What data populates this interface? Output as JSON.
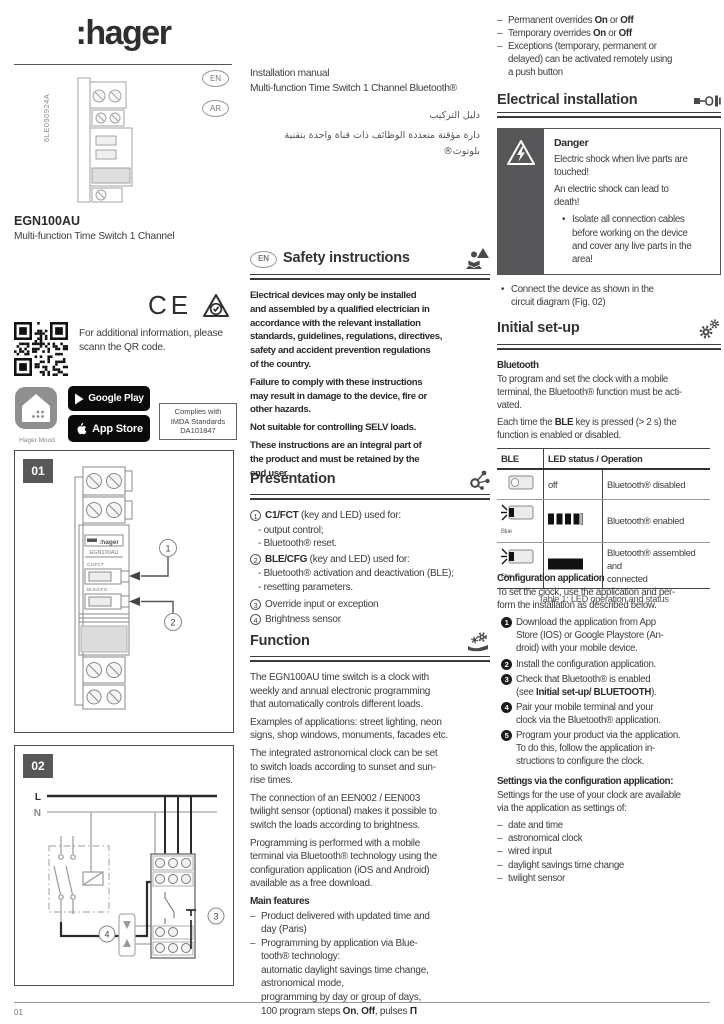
{
  "glyphs": {
    "dash": "–",
    "bullet": "•"
  },
  "page": {
    "footer_page": "01"
  },
  "left": {
    "logo": ":hager",
    "doc_code": "6LE090924A",
    "badge_en": "EN",
    "badge_ar": "AR",
    "product_name": "EGN100AU",
    "product_desc": "Multi-function Time Switch 1 Channel",
    "ce_mark": "CE",
    "qr_text": "For additional information, please\nscann the QR code.",
    "mood_label": "Hager Mood",
    "google_play": "Google Play",
    "app_store": "App Store",
    "imda1": "Complies with",
    "imda2": "IMDA Standards",
    "imda3": "DA101847",
    "fig01": {
      "label": "01",
      "device_logo": ":hager",
      "device_name": "EGN100AU",
      "btn1": "C1/FCT",
      "btn2": "BLE/CFG",
      "c1": "1",
      "c2": "2"
    },
    "fig02": {
      "label": "02",
      "l": "L",
      "n": "N",
      "c3": "3",
      "c4": "4"
    }
  },
  "middle": {
    "title1": "Installation manual",
    "title2": "Multi-function Time Switch 1 Channel Bluetooth®",
    "arabic1": "دليل التركيب",
    "arabic2": "دارة مؤقتة متعددة الوظائف ذات قناة واحدة بتقنية بلوتوث®",
    "safety": {
      "badge": "EN",
      "heading": "Safety instructions",
      "p1": "Electrical devices may only be installed\nand assembled by a qualified electrician in\naccordance with the relevant installation\nstandards, guidelines, regulations, directives,\nsafety and accident prevention regulations\nof the country.",
      "p2": "Failure to comply with these instructions\nmay result in damage to the device, fire or\nother hazards.",
      "p3": "Not suitable for controlling SELV loads.",
      "p4": "These instructions are an integral part of\nthe product and must be retained by the\nend user."
    },
    "presentation": {
      "heading": "Presentation",
      "n1": "1",
      "i1_bold": "C1/FCT",
      "i1_rest": " (key and LED) used for:",
      "i1_sub1": "- output control;",
      "i1_sub2": "- Bluetooth® reset.",
      "n2": "2",
      "i2_bold": "BLE/CFG",
      "i2_rest": " (key and LED) used for:",
      "i2_sub1": "- Bluetooth® activation and deactivation (BLE);",
      "i2_sub2": "- resetting parameters.",
      "n3": "3",
      "i3": "Override input or exception",
      "n4": "4",
      "i4": "Brightness sensor"
    },
    "function": {
      "heading": "Function",
      "p1": "The EGN100AU time switch is a clock with\nweekly and annual electronic programming\nthat automatically controls different loads.",
      "p2": "Examples of applications: street lighting, neon\nsigns, shop windows, monuments, facades etc.",
      "p3": "The integrated astronomical clock can be set\nto switch loads according to sunset and sun-\nrise times.",
      "p4": "The connection of an EEN002 / EEN003\ntwilight sensor (optional) makes it possible to\nswitch the loads according to brightness.",
      "p5": "Programming is performed with a mobile\nterminal via Bluetooth® technology using the\nconfiguration application (iOS and Android)\navailable as a free download.",
      "main_features": "Main features",
      "f1": "Product delivered with updated time and\nday (Paris)",
      "f2": "Programming by application via Blue-\ntooth® technology:\nautomatic daylight savings time change,\nastronomical mode,\nprogramming by day or group of days,\n",
      "f2_pre": "100 program steps ",
      "f2_on": "On",
      "f2_c1": ", ",
      "f2_off": "Off",
      "f2_c2": ", pulses ",
      "f2_pulse": "Π"
    }
  },
  "right": {
    "overrides": {
      "o1_pre": "Permanent overrides ",
      "o1_on": "On",
      "o1_or": " or ",
      "o1_off": "Off",
      "o2_pre": "Temporary overrides ",
      "o2_on": "On",
      "o2_or": " or ",
      "o2_off": "Off",
      "o3": "Exceptions (temporary, permanent or\ndelayed) can be activated remotely using\na push button"
    },
    "electrical": {
      "heading": "Electrical installation"
    },
    "danger": {
      "title": "Danger",
      "p1": "Electric shock when live parts are\ntouched!",
      "p2": "An electric shock can lead to\ndeath!",
      "b1": "Isolate all connection cables\nbefore working on the device\nand cover any live parts in the\narea!"
    },
    "connect": "Connect the device as shown in the\ncircuit diagram (Fig. 02)",
    "initial": {
      "heading": "Initial set-up",
      "sub": "Bluetooth",
      "p1": "To program and set the clock with a mobile\nterminal, the Bluetooth® function must be acti-\nvated.",
      "p2_pre": "Each time the ",
      "p2_bold": "BLE",
      "p2_post": " key is pressed (> 2 s) the\nfunction is enabled or disabled."
    },
    "table": {
      "h1": "BLE",
      "h2": "LED status / Operation",
      "r1_led": "off",
      "r1_desc": "Bluetooth® disabled",
      "r2_label": "Blue",
      "r2_desc": "Bluetooth® enabled",
      "r3_label": "Blue",
      "r3_desc": "Bluetooth® assembled and\nconnected",
      "caption": "Table 1: LED operation and status"
    },
    "config": {
      "heading": "Configuration application",
      "intro": "To set the clock, use the application and per-\nform the installation as described below.",
      "n1": "1",
      "s1": "Download the application from App\nStore (IOS) or Google Playstore (An-\ndroid) with your mobile device.",
      "n2": "2",
      "s2": "Install the configuration application.",
      "n3": "3",
      "s3_pre": "Check that Bluetooth® is enabled\n(see ",
      "s3_bold": "Initial set-up/ BLUETOOTH",
      "s3_post": ").",
      "n4": "4",
      "s4": "Pair your mobile terminal and your\nclock via the Bluetooth® application.",
      "n5": "5",
      "s5": "Program your product via the application.\nTo do this, follow the application in-\nstructions to configure the clock."
    },
    "settings": {
      "heading": "Settings via the configuration application:",
      "intro": "Settings for the use of your clock are available\nvia the application as settings of:",
      "items": [
        "date and time",
        "astronomical clock",
        "wired input",
        "daylight savings time change",
        "twilight sensor"
      ]
    }
  }
}
